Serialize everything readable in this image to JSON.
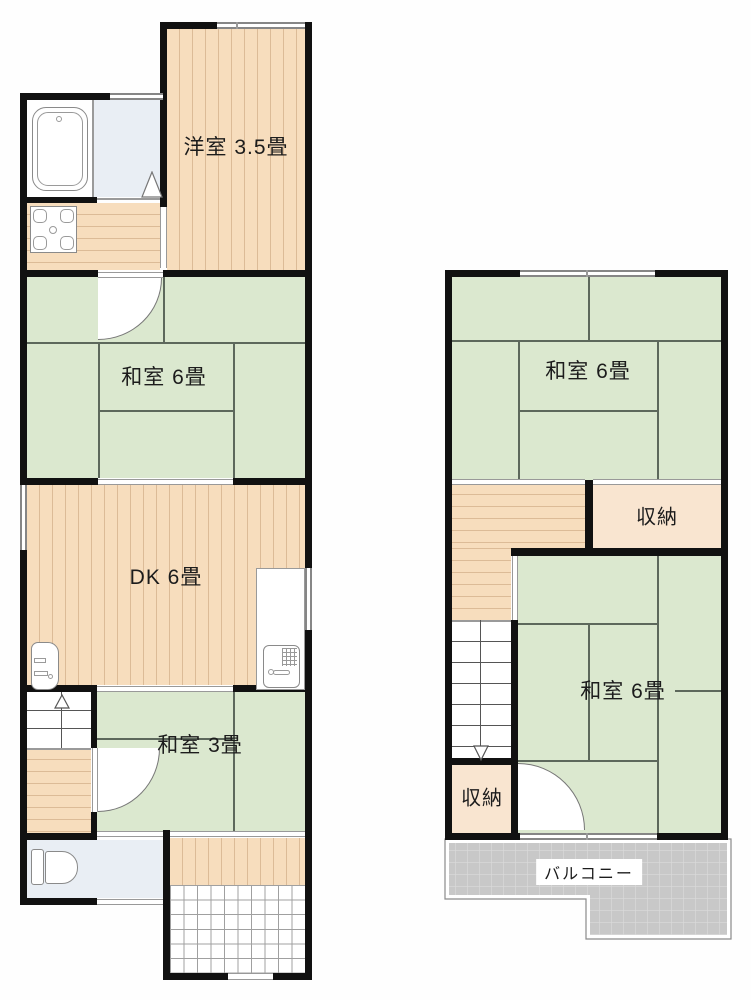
{
  "floor1": {
    "rooms": {
      "yoshitsu": {
        "label": "洋室 3.5畳",
        "type": "western-room",
        "floor_finish": "wood"
      },
      "washitsu6": {
        "label": "和室 6畳",
        "type": "japanese-room",
        "floor_finish": "tatami"
      },
      "dk": {
        "label": "DK 6畳",
        "type": "dining-kitchen",
        "floor_finish": "wood"
      },
      "washitsu3": {
        "label": "和室 3畳",
        "type": "japanese-room",
        "floor_finish": "tatami"
      }
    },
    "fixtures": [
      "bathtub",
      "gas-stove",
      "washbasin",
      "kitchen-sink",
      "toilet",
      "stairs-up"
    ]
  },
  "floor2": {
    "rooms": {
      "washitsu6_north": {
        "label": "和室 6畳",
        "type": "japanese-room",
        "floor_finish": "tatami"
      },
      "closet_north": {
        "label": "収納",
        "type": "storage"
      },
      "washitsu6_south": {
        "label": "和室 6畳",
        "type": "japanese-room",
        "floor_finish": "tatami"
      },
      "closet_south": {
        "label": "収納",
        "type": "storage"
      },
      "balcony": {
        "label": "バルコニー",
        "type": "balcony"
      }
    },
    "fixtures": [
      "stairs-down"
    ]
  },
  "colors": {
    "tatami": "#dbe8cf",
    "wood": "#f7ddbd",
    "wood_line": "#dcbb97",
    "closet": "#f9e5d0",
    "wet_room": "#e9eef4",
    "balcony_fill": "#c8c8c8",
    "balcony_grid": "#d9d9d9",
    "wall": "#111111",
    "tatami_line": "#5d685c",
    "text": "#1c1c1c"
  }
}
